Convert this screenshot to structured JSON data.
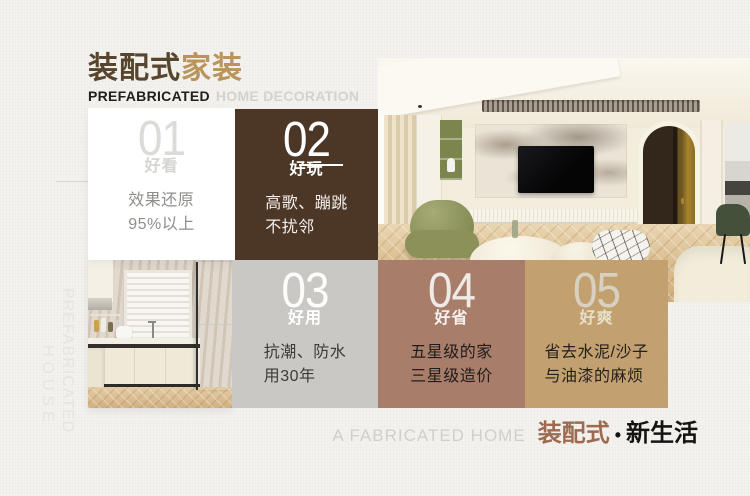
{
  "header": {
    "title": {
      "brown": "装配式",
      "tan": "家装"
    },
    "subtitle": {
      "dark": "PREFABRICATED",
      "light": "HOME DECORATION"
    }
  },
  "side_text": {
    "line1": "PREFABRICATED",
    "line2": "HOUSE"
  },
  "cards": [
    {
      "number": "01",
      "label": "好看",
      "line1": "效果还原",
      "line2": "95%以上"
    },
    {
      "number": "02",
      "label": "好玩",
      "line1": "高歌、蹦跳",
      "line2": "不扰邻"
    },
    {
      "number": "03",
      "label": "好用",
      "line1": "抗潮、防水",
      "line2": "用30年"
    },
    {
      "number": "04",
      "label": "好省",
      "line1": "五星级的家",
      "line2": "三星级造价"
    },
    {
      "number": "05",
      "label": "好爽",
      "line1": "省去水泥/沙子",
      "line2": "与油漆的麻烦"
    }
  ],
  "tagline": {
    "en": "A FABRICATED HOME",
    "brand": "装配式",
    "dot": "•",
    "suffix": "新生活"
  },
  "colors": {
    "page_bg": "#f3f2ee",
    "brand_brown": "#57452e",
    "brand_tan": "#b9945c",
    "card_dark_brown": "#4c3626",
    "card_gray": "#c9c8c5",
    "card_mauve": "#a87d6a",
    "card_tan": "#c3a06f",
    "tagline_brown": "#9d6a50"
  }
}
